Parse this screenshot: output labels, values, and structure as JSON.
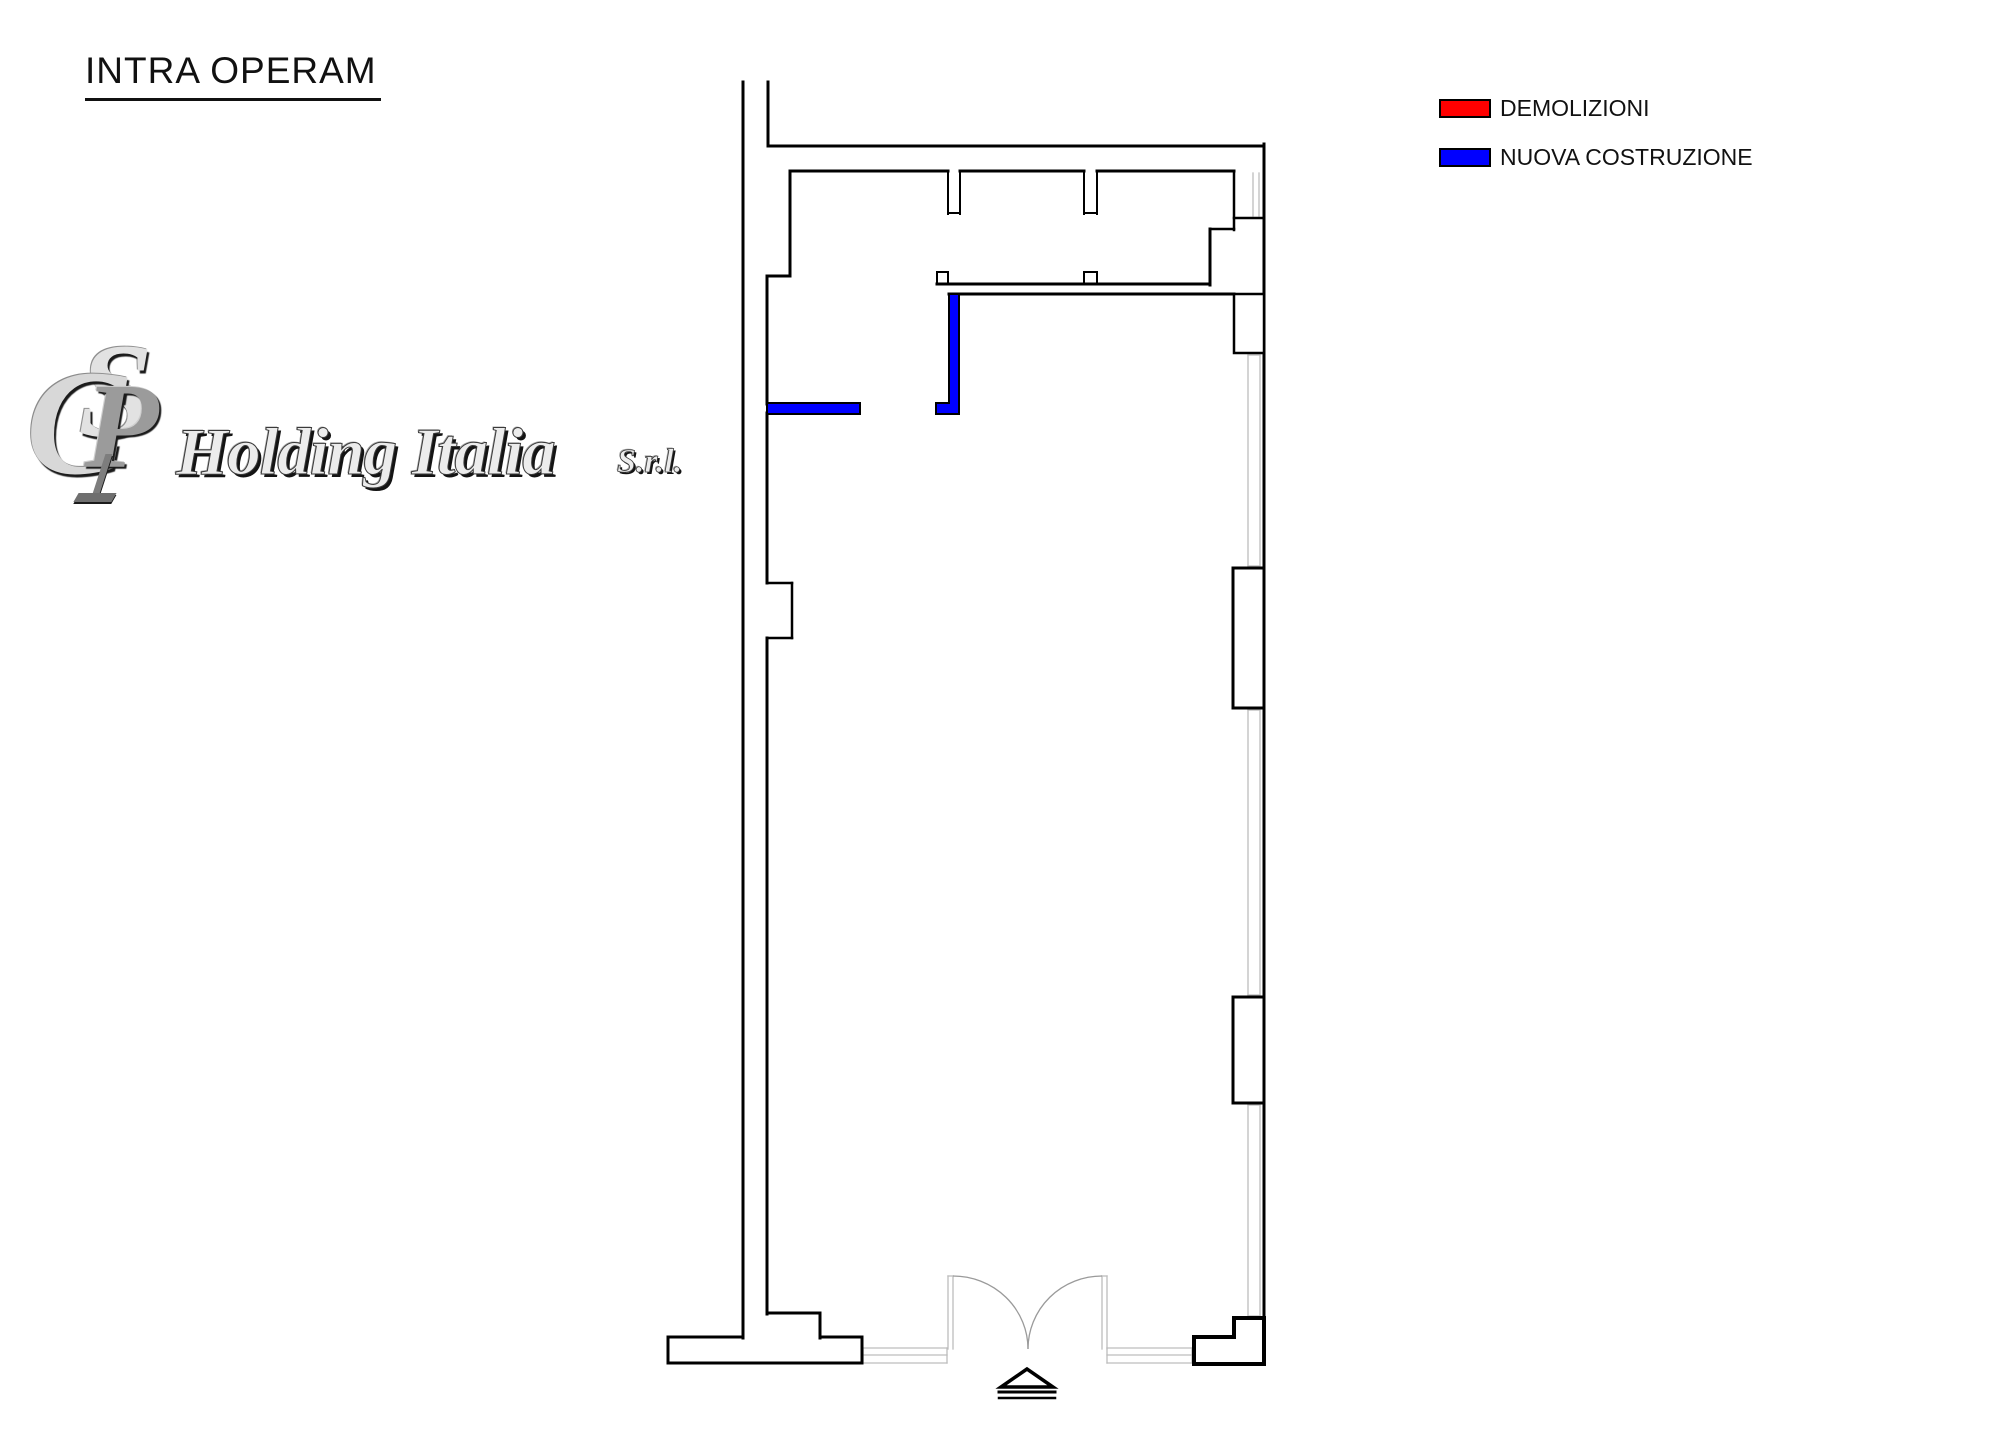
{
  "title": {
    "text": "INTRA OPERAM"
  },
  "legend": {
    "items": [
      {
        "label": "DEMOLIZIONI",
        "color": "#ff0000"
      },
      {
        "label": "NUOVA COSTRUZIONE",
        "color": "#0000ff"
      }
    ]
  },
  "logo": {
    "monogram": {
      "letter_c": "C",
      "letter_p": "P",
      "letter_s": "S"
    },
    "company": "Holding Italia",
    "suffix": "S.r.l."
  },
  "plan": {
    "colors": {
      "wall": "#000000",
      "glazing": "#bdbdbd",
      "door_swing": "#9a9a9a",
      "new_construction": "#0000ff",
      "fill": "#ffffff"
    },
    "walls": [
      [
        743,
        82,
        743,
        1338,
        3
      ],
      [
        768,
        82,
        768,
        146,
        3
      ],
      [
        768,
        146,
        1264,
        146,
        3
      ],
      [
        1264,
        144,
        1264,
        1364,
        3
      ],
      [
        790,
        171,
        948,
        171,
        3
      ],
      [
        960,
        171,
        1084,
        171,
        3
      ],
      [
        1097,
        171,
        1234,
        171,
        3
      ],
      [
        948,
        171,
        948,
        214,
        2
      ],
      [
        960,
        171,
        960,
        214,
        2
      ],
      [
        948,
        213,
        960,
        213,
        2
      ],
      [
        1084,
        171,
        1084,
        214,
        2
      ],
      [
        1097,
        171,
        1097,
        214,
        2
      ],
      [
        1084,
        213,
        1097,
        213,
        2
      ],
      [
        790,
        171,
        790,
        276,
        3
      ],
      [
        767,
        276,
        790,
        276,
        3
      ],
      [
        767,
        276,
        767,
        404,
        3
      ],
      [
        767,
        413,
        767,
        583,
        3
      ],
      [
        767,
        583,
        792,
        583,
        2.5
      ],
      [
        792,
        583,
        792,
        638,
        2.5
      ],
      [
        767,
        638,
        792,
        638,
        2.5
      ],
      [
        767,
        638,
        767,
        1314,
        3
      ],
      [
        767,
        1313,
        820,
        1313,
        3
      ],
      [
        820,
        1313,
        820,
        1338,
        3
      ],
      [
        1234,
        171,
        1234,
        230,
        2.5
      ],
      [
        1234,
        218,
        1264,
        218,
        2.5
      ],
      [
        1210,
        229,
        1234,
        229,
        2.5
      ],
      [
        1210,
        229,
        1210,
        285,
        3
      ],
      [
        937,
        284,
        1210,
        284,
        3
      ],
      [
        949,
        294,
        1234,
        294,
        3
      ],
      [
        937,
        272,
        937,
        284,
        2
      ],
      [
        937,
        272,
        948,
        272,
        2
      ],
      [
        948,
        272,
        948,
        284,
        2
      ],
      [
        1084,
        272,
        1084,
        284,
        2
      ],
      [
        1097,
        272,
        1097,
        284,
        2
      ],
      [
        1084,
        272,
        1097,
        272,
        2
      ],
      [
        668,
        1363,
        862,
        1363,
        3
      ],
      [
        668,
        1337,
        743,
        1337,
        3
      ],
      [
        820,
        1337,
        862,
        1337,
        3
      ],
      [
        668,
        1337,
        668,
        1363,
        3
      ],
      [
        862,
        1337,
        862,
        1363,
        3
      ]
    ],
    "piers": [
      {
        "x": 1234,
        "y": 294,
        "w": 30,
        "h": 59,
        "sw": 2.5
      },
      {
        "x": 1233,
        "y": 568,
        "w": 31,
        "h": 140,
        "sw": 3
      },
      {
        "x": 1233,
        "y": 997,
        "w": 31,
        "h": 106,
        "sw": 3
      }
    ],
    "corner_block": {
      "points": "1194,1337 1234,1337 1234,1318 1264,1318 1264,1364 1194,1364",
      "sw": 4
    },
    "glazing": [
      [
        1253,
        173,
        1253,
        216
      ],
      [
        1259,
        173,
        1259,
        216
      ],
      [
        1248,
        355,
        1248,
        566
      ],
      [
        1260,
        355,
        1260,
        566
      ],
      [
        1248,
        355,
        1260,
        355
      ],
      [
        1248,
        566,
        1260,
        566
      ],
      [
        1248,
        710,
        1248,
        995
      ],
      [
        1260,
        710,
        1260,
        995
      ],
      [
        1248,
        710,
        1260,
        710
      ],
      [
        1248,
        995,
        1260,
        995
      ],
      [
        1248,
        1105,
        1248,
        1316
      ],
      [
        1260,
        1105,
        1260,
        1316
      ],
      [
        1248,
        1105,
        1260,
        1105
      ],
      [
        1248,
        1316,
        1260,
        1316
      ],
      [
        948,
        1276,
        948,
        1349
      ],
      [
        953,
        1276,
        953,
        1349
      ],
      [
        948,
        1276,
        953,
        1276
      ],
      [
        1102,
        1276,
        1102,
        1349
      ],
      [
        1107,
        1276,
        1107,
        1349
      ],
      [
        1102,
        1276,
        1107,
        1276
      ],
      [
        863,
        1348,
        947,
        1348
      ],
      [
        863,
        1363,
        947,
        1363
      ],
      [
        863,
        1348,
        863,
        1363
      ],
      [
        947,
        1348,
        947,
        1363
      ],
      [
        863,
        1355,
        947,
        1355
      ],
      [
        1107,
        1348,
        1192,
        1348
      ],
      [
        1107,
        1363,
        1192,
        1363
      ],
      [
        1107,
        1348,
        1107,
        1363
      ],
      [
        1192,
        1348,
        1192,
        1363
      ],
      [
        1107,
        1355,
        1192,
        1355
      ]
    ],
    "door_swing_arcs": [
      "M953,1276 A75,73 0 0 1 1028,1349",
      "M1102,1276 A74,73 0 0 0 1028,1349"
    ],
    "new_construction": [
      {
        "type": "rect",
        "x": 767,
        "y": 403,
        "w": 93,
        "h": 11
      },
      {
        "type": "polygon",
        "points": "949,294 959,294 959,414 936,414 936,403 949,403"
      }
    ],
    "entrance_marker": {
      "triangle": "1027,1369 1001,1387 1053,1387",
      "lines": [
        [
          999,
          1392,
          1055,
          1392,
          3
        ],
        [
          999,
          1398,
          1055,
          1398,
          2.5
        ]
      ]
    }
  }
}
